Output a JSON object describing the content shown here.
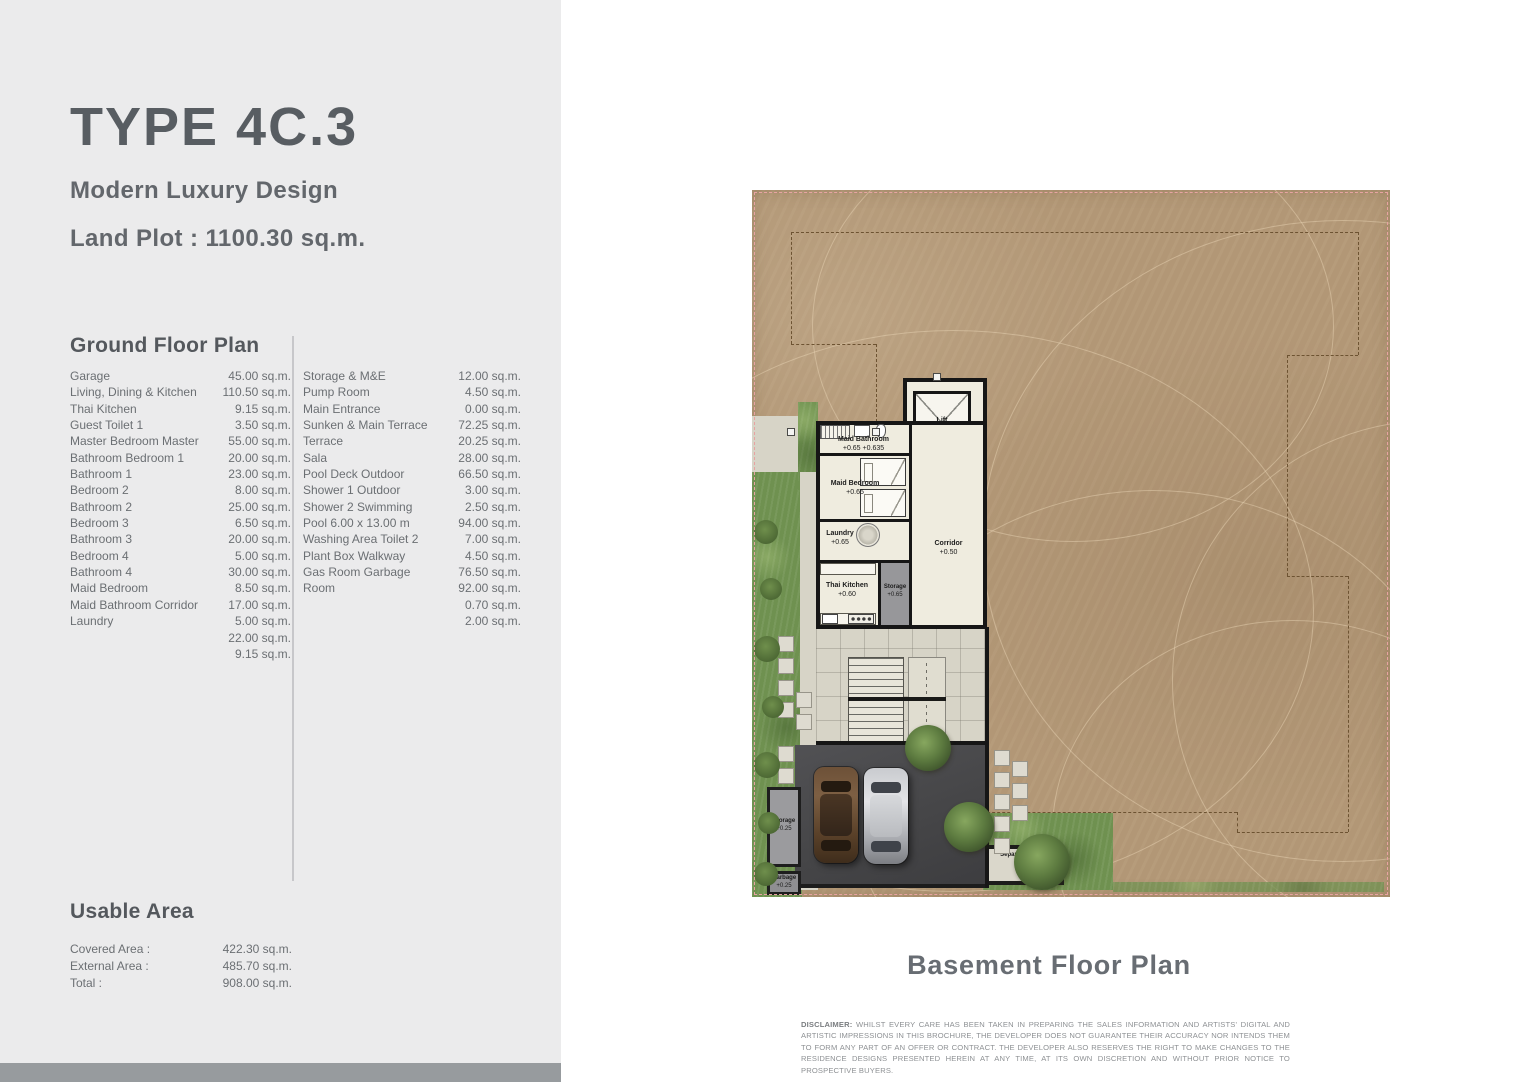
{
  "header": {
    "title": "TYPE 4C.3",
    "subtitle": "Modern Luxury Design",
    "land_plot": "Land Plot : 1100.30 sq.m."
  },
  "ground_floor_plan": {
    "heading": "Ground Floor Plan",
    "left_rows": [
      {
        "label": "Garage",
        "value": "45.00 sq.m."
      },
      {
        "label": "Living, Dining & Kitchen",
        "value": "110.50 sq.m."
      },
      {
        "label": "Thai Kitchen",
        "value": "9.15 sq.m."
      },
      {
        "label": "Guest Toilet 1",
        "value": "3.50 sq.m."
      },
      {
        "label": "Master Bedroom Master",
        "value": "55.00 sq.m."
      },
      {
        "label": "Bathroom Bedroom 1",
        "value": "20.00 sq.m."
      },
      {
        "label": "Bathroom 1",
        "value": "23.00 sq.m."
      },
      {
        "label": "Bedroom 2",
        "value": "8.00 sq.m."
      },
      {
        "label": "Bathroom 2",
        "value": "25.00 sq.m."
      },
      {
        "label": "Bedroom 3",
        "value": "6.50 sq.m."
      },
      {
        "label": "Bathroom 3",
        "value": "20.00 sq.m."
      },
      {
        "label": "Bedroom 4",
        "value": "5.00 sq.m."
      },
      {
        "label": "Bathroom 4",
        "value": "30.00 sq.m."
      },
      {
        "label": "Maid Bedroom",
        "value": "8.50 sq.m."
      },
      {
        "label": "Maid Bathroom Corridor",
        "value": "17.00 sq.m."
      },
      {
        "label": "Laundry",
        "value": "5.00 sq.m."
      },
      {
        "label": "",
        "value": "22.00 sq.m."
      },
      {
        "label": "",
        "value": "9.15 sq.m."
      }
    ],
    "right_rows": [
      {
        "label": "Storage & M&E",
        "value": "12.00 sq.m."
      },
      {
        "label": "Pump Room",
        "value": "4.50 sq.m."
      },
      {
        "label": "Main Entrance",
        "value": "0.00 sq.m."
      },
      {
        "label": "Sunken & Main Terrace",
        "value": "72.25 sq.m."
      },
      {
        "label": "Terrace",
        "value": "20.25 sq.m."
      },
      {
        "label": "Sala",
        "value": "28.00 sq.m."
      },
      {
        "label": "Pool Deck Outdoor",
        "value": "66.50 sq.m."
      },
      {
        "label": "Shower 1 Outdoor",
        "value": "3.00 sq.m."
      },
      {
        "label": "Shower 2 Swimming",
        "value": "2.50 sq.m."
      },
      {
        "label": "Pool 6.00 x 13.00 m",
        "value": "94.00 sq.m."
      },
      {
        "label": "Washing Area Toilet 2",
        "value": "7.00 sq.m."
      },
      {
        "label": "Plant Box Walkway",
        "value": "4.50 sq.m."
      },
      {
        "label": "Gas Room Garbage",
        "value": "76.50 sq.m."
      },
      {
        "label": "Room",
        "value": "92.00 sq.m."
      },
      {
        "label": "",
        "value": "0.70 sq.m."
      },
      {
        "label": "",
        "value": "2.00 sq.m."
      }
    ]
  },
  "usable_area": {
    "heading": "Usable Area",
    "rows": [
      {
        "label": "Covered Area :",
        "value": "422.30 sq.m."
      },
      {
        "label": "External Area :",
        "value": "485.70 sq.m."
      },
      {
        "label": "Total :",
        "value": "908.00 sq.m."
      }
    ]
  },
  "plan": {
    "caption": "Basement Floor Plan",
    "labels": {
      "lift": "Lift",
      "maid_bathroom": "Maid Bathroom",
      "maid_bathroom_level": "+0.65 +0.635",
      "maid_bedroom": "Maid Bedroom",
      "maid_bedroom_level": "+0.65",
      "laundry": "Laundry",
      "laundry_level": "+0.65",
      "corridor": "Corridor",
      "corridor_level": "+0.50",
      "thai_kitchen": "Thai Kitchen",
      "thai_kitchen_level": "+0.60",
      "storage_inner": "Storage",
      "storage_inner_level": "+0.65",
      "garage": "Garage",
      "garage_level": "+0.00",
      "storage_outer": "Storage",
      "storage_outer_level": "+0.25",
      "garbage": "Garbage",
      "garbage_level": "+0.25",
      "separate_entrance": "Separate Entrance",
      "separate_entrance_level": "+0.25"
    }
  },
  "disclaimer": {
    "label": "DISCLAIMER:",
    "text": " WHILST EVERY CARE HAS BEEN TAKEN IN PREPARING THE SALES INFORMATION AND ARTISTS' DIGITAL AND ARTISTIC IMPRESSIONS IN THIS BROCHURE, THE DEVELOPER DOES NOT GUARANTEE THEIR ACCURACY NOR INTENDS THEM TO FORM ANY PART OF AN OFFER OR CONTRACT. THE DEVELOPER ALSO RESERVES THE RIGHT TO MAKE CHANGES TO THE RESIDENCE DESIGNS PRESENTED HEREIN AT ANY TIME, AT ITS OWN DISCRETION AND WITHOUT PRIOR NOTICE TO PROSPECTIVE BUYERS."
  },
  "colors": {
    "panel_grey": "#ebebec",
    "plot_border_pink": "#e8a3a3",
    "dirt": "#b29776",
    "grass": "#6f9150",
    "garage_slab": "#49494b",
    "text_grey": "#6b6f73"
  }
}
